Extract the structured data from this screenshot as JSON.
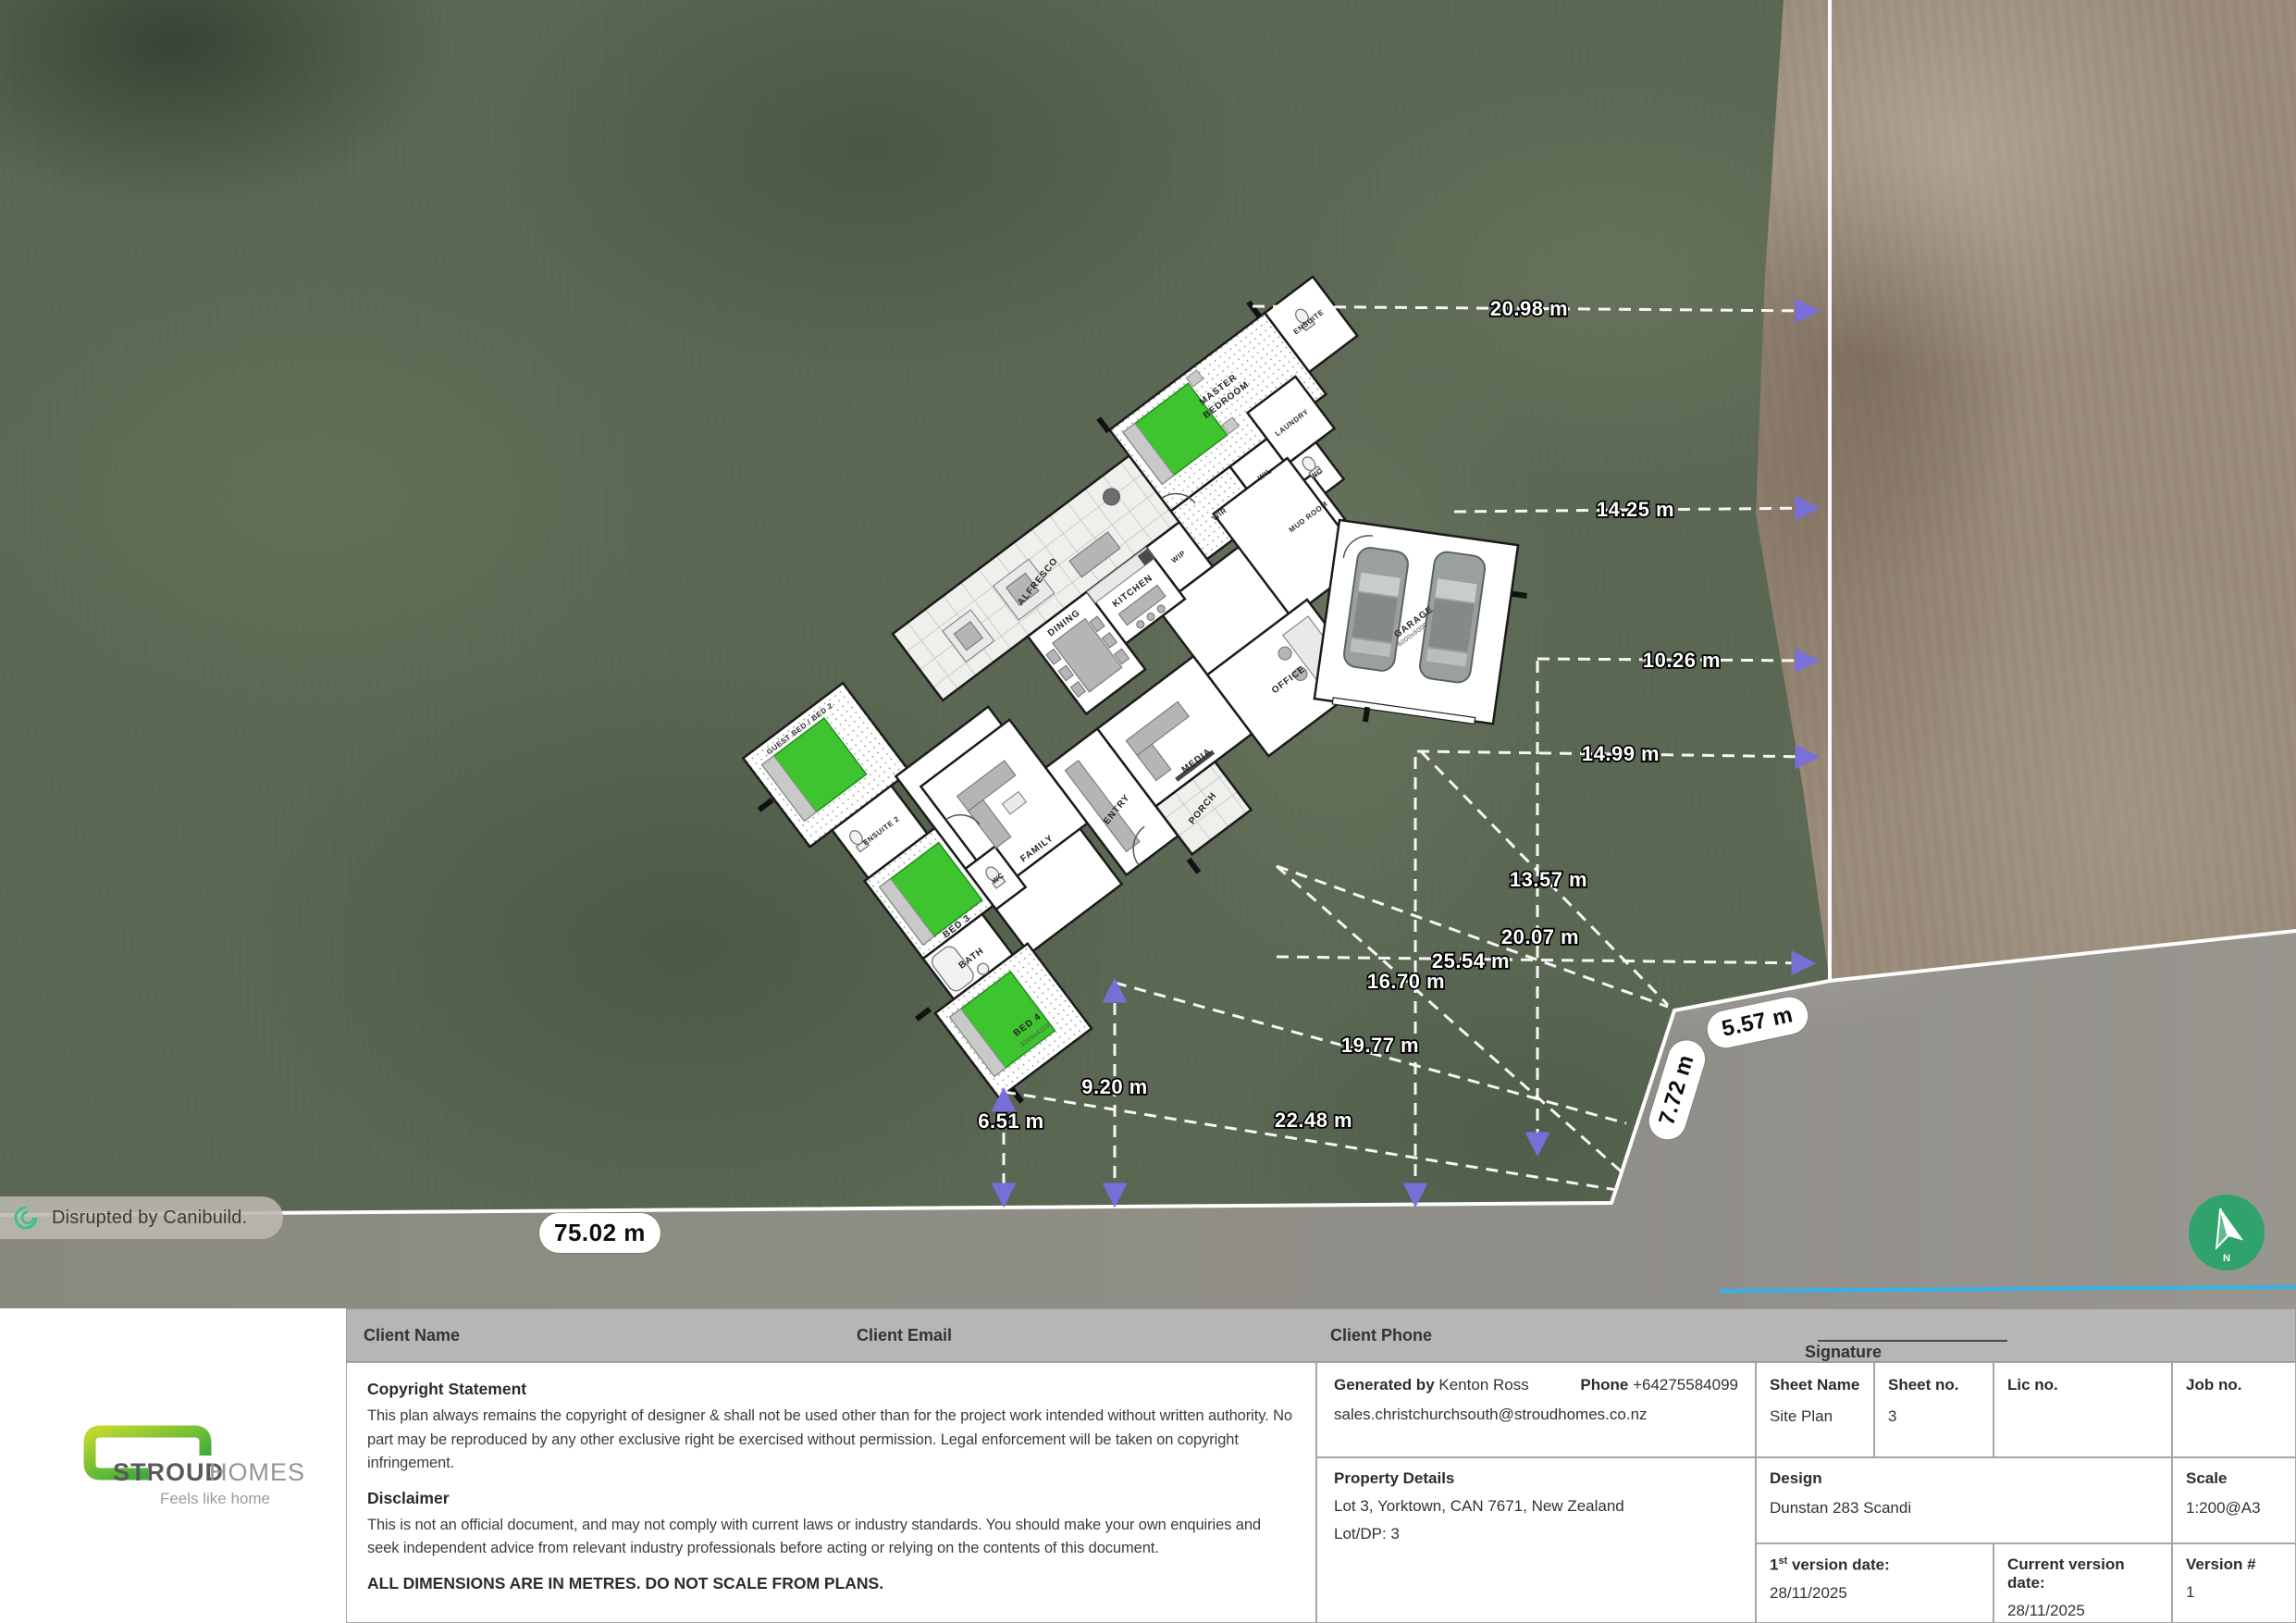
{
  "map": {
    "badge": "Disrupted by Canibuild.",
    "north": "N",
    "pills": {
      "bottom": "75.02 m",
      "east": "5.57 m",
      "southeast": "7.72 m"
    },
    "dims": {
      "d1": "20.98 m",
      "d2": "14.25 m",
      "d3": "10.26 m",
      "d4": "14.99 m",
      "d5": "13.57 m",
      "d6": "20.07 m",
      "d7": "25.54 m",
      "d8": "16.70 m",
      "d9": "19.77 m",
      "d10": "22.48 m",
      "d11": "9.20 m",
      "d12": "6.51 m"
    }
  },
  "plan": {
    "rooms": {
      "alfresco": "ALFRESCO",
      "master_l1": "MASTER",
      "master_l2": "BEDROOM",
      "ensuite": "ENSUITE",
      "wir": "WIR",
      "wil": "WIL",
      "laundry": "LAUNDRY",
      "wc_garage": "WC",
      "mudroom": "MUD ROOM",
      "wip": "WIP",
      "kitchen": "KITCHEN",
      "dining": "DINING",
      "family": "FAMILY",
      "entry": "ENTRY",
      "porch": "PORCH",
      "media": "MEDIA",
      "office": "OFFICE",
      "guest": "GUEST BED / BED 2",
      "ensuite2": "ENSUITE 2",
      "bed3": "BED 3",
      "bath": "BATH",
      "wc_wing": "WC",
      "bed4": "BED 4",
      "bed4_dim": "3200x4110",
      "garage": "GARAGE",
      "garage_dim": "6000x6000"
    }
  },
  "titleblock": {
    "client_name_label": "Client Name",
    "client_email_label": "Client Email",
    "client_phone_label": "Client Phone",
    "signature_label": "Signature",
    "copyright_title": "Copyright Statement",
    "copyright_body": "This plan always remains the copyright of designer & shall not be used other than for the project work intended without written authority. No part may be reproduced by any other exclusive right be exercised without permission. Legal enforcement will be taken on copyright infringement.",
    "disclaimer_title": "Disclaimer",
    "disclaimer_body": "This is not an official document, and may not comply with current laws or industry standards. You should make your own enquiries and seek independent advice from relevant industry professionals before acting or relying on the contents of this document.",
    "dimensions_note": "ALL DIMENSIONS ARE IN METRES. DO NOT SCALE FROM PLANS.",
    "generated_by_label": "Generated by",
    "generated_by_value": "Kenton Ross",
    "phone_label": "Phone",
    "phone_value": "+64275584099",
    "email_value": "sales.christchurchsouth@stroudhomes.co.nz",
    "sheet_name_label": "Sheet Name",
    "sheet_name_value": "Site Plan",
    "sheet_no_label": "Sheet no.",
    "sheet_no_value": "3",
    "lic_no_label": "Lic no.",
    "job_no_label": "Job no.",
    "property_title": "Property Details",
    "property_line1": "Lot 3, Yorktown, CAN 7671, New Zealand",
    "property_line2": "Lot/DP: 3",
    "design_label": "Design",
    "design_value": "Dunstan 283 Scandi",
    "scale_label": "Scale",
    "scale_value": "1:200@A3",
    "v1_num": "1",
    "v1_sup": "st",
    "v1_rest": " version date:",
    "v1_value": "28/11/2025",
    "cur_label": "Current version date:",
    "cur_value": "28/11/2025",
    "ver_label": "Version #",
    "ver_value": "1"
  },
  "logo": {
    "brand_bold": "STROUD",
    "brand_light": "HOMES",
    "tagline": "Feels like home"
  },
  "colors": {
    "accent_green": "#2fa36b",
    "bed_green": "#3ec42f",
    "arrow_purple": "#7a6fe0",
    "cyan": "#30b4ea",
    "logo_green_1": "#c3d82e",
    "logo_green_2": "#17a03f"
  }
}
